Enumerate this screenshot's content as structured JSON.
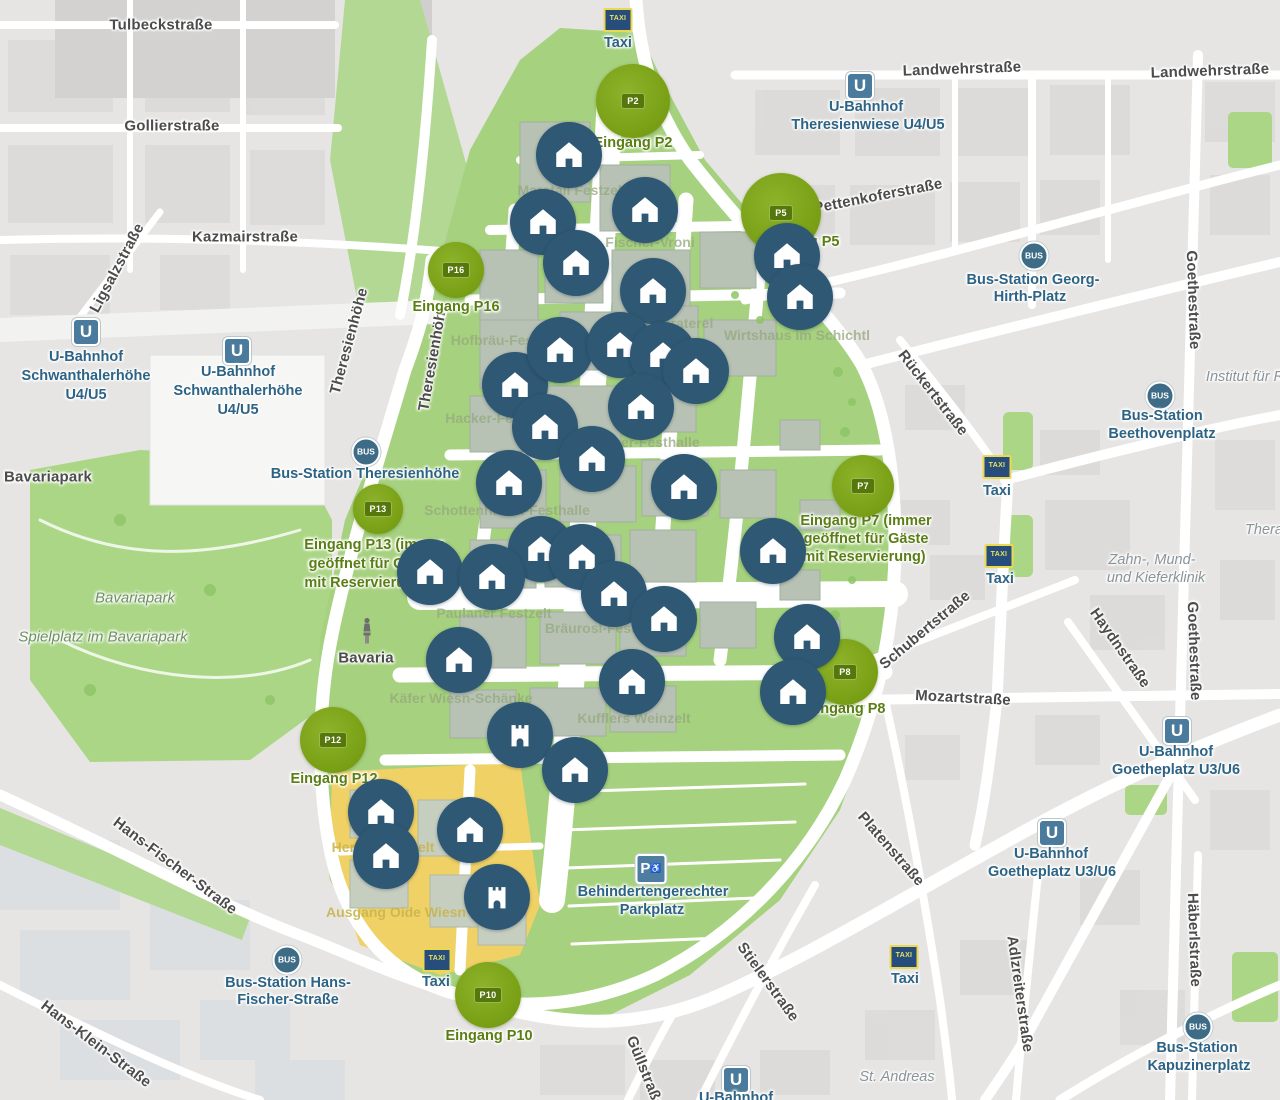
{
  "map": {
    "colors": {
      "city_gray": "#e6e5e3",
      "block_gray": "#d9d8d6",
      "road_white": "#ffffff",
      "park_green": "#a6d17e",
      "oide_wiesn_yellow": "#f0d166",
      "venue_marker_blue": "#2e5873",
      "entrance_green": "#7aa016",
      "entrance_badge_green": "#55770c",
      "entrance_label_green": "#5b7e14",
      "transit_blue": "#2d6385",
      "taxi_sign_blue": "#274d7c",
      "taxi_sign_border_yellow": "#ecd94f",
      "street_label_gray": "#4c4c4c",
      "faint_label_green": "#95a87e",
      "faint_label_yellow": "#c9b54e"
    },
    "icons": {
      "ubahn_text": "U",
      "bus_text": "BUS",
      "taxi_sign_text": "TAXI",
      "parking_text": "P",
      "wheelchair_glyph": "♿"
    },
    "street_labels": [
      {
        "text": "Tulbeckstraße",
        "x": 161,
        "y": 25,
        "rot": 0
      },
      {
        "text": "Gollierstraße",
        "x": 172,
        "y": 126,
        "rot": 0
      },
      {
        "text": "Kazmairstraße",
        "x": 245,
        "y": 237,
        "rot": 0
      },
      {
        "text": "Ligsalzstraße",
        "x": 117,
        "y": 268,
        "rot": -62
      },
      {
        "text": "Theresienhöhe",
        "x": 349,
        "y": 341,
        "rot": -75
      },
      {
        "text": "Theresienhöhe",
        "x": 433,
        "y": 357,
        "rot": -80
      },
      {
        "text": "Landwehrstraße",
        "x": 962,
        "y": 69,
        "rot": -2
      },
      {
        "text": "Landwehrstraße",
        "x": 1210,
        "y": 71,
        "rot": -2
      },
      {
        "text": "Pettenkoferstraße",
        "x": 878,
        "y": 196,
        "rot": -11
      },
      {
        "text": "Rückertstraße",
        "x": 933,
        "y": 393,
        "rot": 52
      },
      {
        "text": "Schubertstraße",
        "x": 925,
        "y": 630,
        "rot": -40
      },
      {
        "text": "Mozartstraße",
        "x": 963,
        "y": 698,
        "rot": 3
      },
      {
        "text": "Haydnstraße",
        "x": 1120,
        "y": 648,
        "rot": 55
      },
      {
        "text": "Goethestraße",
        "x": 1193,
        "y": 300,
        "rot": 88
      },
      {
        "text": "Goethestraße",
        "x": 1194,
        "y": 651,
        "rot": 88
      },
      {
        "text": "Häberlstraße",
        "x": 1194,
        "y": 940,
        "rot": 88
      },
      {
        "text": "Adlzreiterstraße",
        "x": 1020,
        "y": 994,
        "rot": 82
      },
      {
        "text": "Platenstraße",
        "x": 891,
        "y": 849,
        "rot": 49
      },
      {
        "text": "Stielerstraße",
        "x": 768,
        "y": 982,
        "rot": 54
      },
      {
        "text": "Güllstraße",
        "x": 645,
        "y": 1072,
        "rot": 68
      },
      {
        "text": "Hans-Fischer-Straße",
        "x": 175,
        "y": 866,
        "rot": 37
      },
      {
        "text": "Hans-Klein-Straße",
        "x": 96,
        "y": 1044,
        "rot": 37
      },
      {
        "text": "Bavariapark",
        "x": 48,
        "y": 477,
        "rot": 0
      }
    ],
    "park_labels": [
      {
        "text": "Bavariapark",
        "x": 135,
        "y": 598
      },
      {
        "text": "Spielplatz im Bavariapark",
        "x": 103,
        "y": 637
      }
    ],
    "poi_labels": [
      {
        "text": "Institut für R",
        "x": 1245,
        "y": 377
      },
      {
        "text": "Thera",
        "x": 1264,
        "y": 530
      },
      {
        "text": "Zahn-, Mund-",
        "x": 1152,
        "y": 560
      },
      {
        "text": "und Kieferklinik",
        "x": 1156,
        "y": 578
      },
      {
        "text": "St. Andreas",
        "x": 897,
        "y": 1077
      }
    ],
    "area_labels": [
      {
        "text": "Marstall Festzelt",
        "x": 572,
        "y": 190,
        "tone": "green"
      },
      {
        "text": "Fischer-Vroni",
        "x": 650,
        "y": 242,
        "tone": "green"
      },
      {
        "text": "Ochsenbraterei",
        "x": 662,
        "y": 323,
        "tone": "green"
      },
      {
        "text": "Wirtshaus im Schichtl",
        "x": 797,
        "y": 335,
        "tone": "green"
      },
      {
        "text": "Hofbräu-Festzelt",
        "x": 506,
        "y": 340,
        "tone": "green"
      },
      {
        "text": "Hacker-Festzelt",
        "x": 497,
        "y": 418,
        "tone": "green"
      },
      {
        "text": "Augustiner-Festhalle",
        "x": 630,
        "y": 442,
        "tone": "green"
      },
      {
        "text": "Schottenhamel-Festhalle",
        "x": 507,
        "y": 510,
        "tone": "green"
      },
      {
        "text": "Paulaner Festzelt",
        "x": 494,
        "y": 613,
        "tone": "green"
      },
      {
        "text": "Bräurosl-Festzelt",
        "x": 602,
        "y": 628,
        "tone": "green"
      },
      {
        "text": "Käfer Wiesn-Schänke",
        "x": 461,
        "y": 698,
        "tone": "green"
      },
      {
        "text": "Kufflers Weinzelt",
        "x": 634,
        "y": 718,
        "tone": "green"
      },
      {
        "text": "Herzkasperlzelt",
        "x": 383,
        "y": 847,
        "tone": "yellow"
      },
      {
        "text": "Ausgang Oide Wiesn",
        "x": 396,
        "y": 912,
        "tone": "yellow"
      }
    ],
    "transit_stations": [
      {
        "type": "ubahn",
        "icon": {
          "x": 86,
          "y": 332
        },
        "lines": [
          {
            "text": "U-Bahnhof",
            "x": 86,
            "y": 357
          },
          {
            "text": "Schwanthalerhöhe",
            "x": 86,
            "y": 376
          },
          {
            "text": "U4/U5",
            "x": 86,
            "y": 395
          }
        ]
      },
      {
        "type": "ubahn",
        "icon": {
          "x": 237,
          "y": 351
        },
        "lines": [
          {
            "text": "U-Bahnhof",
            "x": 238,
            "y": 372
          },
          {
            "text": "Schwanthalerhöhe",
            "x": 238,
            "y": 391
          },
          {
            "text": "U4/U5",
            "x": 238,
            "y": 410
          }
        ]
      },
      {
        "type": "ubahn",
        "icon": {
          "x": 860,
          "y": 86
        },
        "lines": [
          {
            "text": "U-Bahnhof",
            "x": 866,
            "y": 107
          },
          {
            "text": "Theresienwiese U4/U5",
            "x": 868,
            "y": 125
          }
        ]
      },
      {
        "type": "ubahn",
        "icon": {
          "x": 1177,
          "y": 731
        },
        "lines": [
          {
            "text": "U-Bahnhof",
            "x": 1176,
            "y": 752
          },
          {
            "text": "Goetheplatz U3/U6",
            "x": 1176,
            "y": 770
          }
        ]
      },
      {
        "type": "ubahn",
        "icon": {
          "x": 1052,
          "y": 833
        },
        "lines": [
          {
            "text": "U-Bahnhof",
            "x": 1051,
            "y": 854
          },
          {
            "text": "Goetheplatz U3/U6",
            "x": 1052,
            "y": 872
          }
        ]
      },
      {
        "type": "ubahn",
        "icon": {
          "x": 736,
          "y": 1080
        },
        "lines": [
          {
            "text": "U-Bahnhof",
            "x": 736,
            "y": 1098
          }
        ]
      },
      {
        "type": "bus",
        "icon": {
          "x": 366,
          "y": 452
        },
        "lines": [
          {
            "text": "Bus-Station Theresienhöhe",
            "x": 365,
            "y": 474
          }
        ]
      },
      {
        "type": "bus",
        "icon": {
          "x": 1034,
          "y": 256
        },
        "lines": [
          {
            "text": "Bus-Station Georg-",
            "x": 1033,
            "y": 280
          },
          {
            "text": "Hirth-Platz",
            "x": 1030,
            "y": 297
          }
        ]
      },
      {
        "type": "bus",
        "icon": {
          "x": 1160,
          "y": 396
        },
        "lines": [
          {
            "text": "Bus-Station",
            "x": 1162,
            "y": 416
          },
          {
            "text": "Beethovenplatz",
            "x": 1162,
            "y": 434
          }
        ]
      },
      {
        "type": "bus",
        "icon": {
          "x": 287,
          "y": 960
        },
        "lines": [
          {
            "text": "Bus-Station Hans-",
            "x": 288,
            "y": 983
          },
          {
            "text": "Fischer-Straße",
            "x": 288,
            "y": 1000
          }
        ]
      },
      {
        "type": "bus",
        "icon": {
          "x": 1198,
          "y": 1027
        },
        "lines": [
          {
            "text": "Bus-Station",
            "x": 1197,
            "y": 1048
          },
          {
            "text": "Kapuzinerplatz",
            "x": 1199,
            "y": 1066
          }
        ]
      }
    ],
    "taxi_stands": [
      {
        "sign": {
          "x": 618,
          "y": 20
        },
        "label": {
          "text": "Taxi",
          "x": 618,
          "y": 43
        }
      },
      {
        "sign": {
          "x": 997,
          "y": 467
        },
        "label": {
          "text": "Taxi",
          "x": 997,
          "y": 491
        }
      },
      {
        "sign": {
          "x": 999,
          "y": 556
        },
        "label": {
          "text": "Taxi",
          "x": 1000,
          "y": 579
        }
      },
      {
        "sign": {
          "x": 437,
          "y": 960
        },
        "label": {
          "text": "Taxi",
          "x": 436,
          "y": 982
        }
      },
      {
        "sign": {
          "x": 904,
          "y": 957
        },
        "label": {
          "text": "Taxi",
          "x": 905,
          "y": 979
        }
      }
    ],
    "parking": {
      "icon": {
        "x": 651,
        "y": 869
      },
      "lines": [
        {
          "text": "Behindertengerechter",
          "x": 653,
          "y": 892
        },
        {
          "text": "Parkplatz",
          "x": 652,
          "y": 910
        }
      ]
    },
    "bavaria": {
      "icon": {
        "x": 367,
        "y": 633
      },
      "label": {
        "text": "Bavaria",
        "x": 366,
        "y": 658
      }
    },
    "entrances": [
      {
        "id": "P2",
        "badge": "P2",
        "x": 633,
        "y": 101,
        "size": 74,
        "label_lines": [
          {
            "text": "Eingang P2",
            "x": 633,
            "y": 143
          }
        ]
      },
      {
        "id": "P5",
        "badge": "P5",
        "x": 781,
        "y": 213,
        "size": 80,
        "label_lines": [
          {
            "text": "Eingang P5",
            "x": 800,
            "y": 242
          }
        ]
      },
      {
        "id": "P16",
        "badge": "P16",
        "x": 456,
        "y": 270,
        "size": 56,
        "label_lines": [
          {
            "text": "Eingang P16",
            "x": 456,
            "y": 307
          }
        ]
      },
      {
        "id": "P13",
        "badge": "P13",
        "x": 378,
        "y": 509,
        "size": 50,
        "label_lines": [
          {
            "text": "Eingang P13 (immer",
            "x": 374,
            "y": 545
          },
          {
            "text": "geöffnet für Gäste",
            "x": 371,
            "y": 564
          },
          {
            "text": "mit Reservierung)",
            "x": 366,
            "y": 583
          }
        ]
      },
      {
        "id": "P7",
        "badge": "P7",
        "x": 863,
        "y": 486,
        "size": 62,
        "label_lines": [
          {
            "text": "Eingang P7 (immer",
            "x": 866,
            "y": 521
          },
          {
            "text": "geöffnet für Gäste",
            "x": 866,
            "y": 539
          },
          {
            "text": "mit Reservierung)",
            "x": 864,
            "y": 557
          }
        ]
      },
      {
        "id": "P8",
        "badge": "P8",
        "x": 845,
        "y": 672,
        "size": 66,
        "label_lines": [
          {
            "text": "Eingang P8",
            "x": 846,
            "y": 709
          }
        ]
      },
      {
        "id": "P12",
        "badge": "P12",
        "x": 333,
        "y": 740,
        "size": 66,
        "label_lines": [
          {
            "text": "Eingang P12",
            "x": 334,
            "y": 779
          }
        ]
      },
      {
        "id": "P10",
        "badge": "P10",
        "x": 488,
        "y": 995,
        "size": 66,
        "label_lines": [
          {
            "text": "Eingang P10",
            "x": 489,
            "y": 1036
          }
        ]
      }
    ],
    "venues": [
      {
        "x": 569,
        "y": 155,
        "icon": "house"
      },
      {
        "x": 543,
        "y": 222,
        "icon": "house"
      },
      {
        "x": 645,
        "y": 210,
        "icon": "house"
      },
      {
        "x": 576,
        "y": 263,
        "icon": "house"
      },
      {
        "x": 653,
        "y": 291,
        "icon": "house"
      },
      {
        "x": 787,
        "y": 256,
        "icon": "house"
      },
      {
        "x": 800,
        "y": 297,
        "icon": "house"
      },
      {
        "x": 515,
        "y": 385,
        "icon": "house"
      },
      {
        "x": 560,
        "y": 350,
        "icon": "house"
      },
      {
        "x": 620,
        "y": 345,
        "icon": "house"
      },
      {
        "x": 663,
        "y": 355,
        "icon": "house"
      },
      {
        "x": 696,
        "y": 371,
        "icon": "house"
      },
      {
        "x": 545,
        "y": 427,
        "icon": "house"
      },
      {
        "x": 641,
        "y": 407,
        "icon": "house"
      },
      {
        "x": 509,
        "y": 483,
        "icon": "house"
      },
      {
        "x": 592,
        "y": 459,
        "icon": "house"
      },
      {
        "x": 684,
        "y": 487,
        "icon": "house"
      },
      {
        "x": 773,
        "y": 551,
        "icon": "house"
      },
      {
        "x": 541,
        "y": 549,
        "icon": "house"
      },
      {
        "x": 582,
        "y": 557,
        "icon": "house"
      },
      {
        "x": 430,
        "y": 572,
        "icon": "house"
      },
      {
        "x": 492,
        "y": 577,
        "icon": "house"
      },
      {
        "x": 614,
        "y": 594,
        "icon": "house"
      },
      {
        "x": 664,
        "y": 619,
        "icon": "house"
      },
      {
        "x": 807,
        "y": 637,
        "icon": "house"
      },
      {
        "x": 459,
        "y": 660,
        "icon": "house"
      },
      {
        "x": 632,
        "y": 682,
        "icon": "house"
      },
      {
        "x": 793,
        "y": 692,
        "icon": "house"
      },
      {
        "x": 520,
        "y": 735,
        "icon": "castle"
      },
      {
        "x": 575,
        "y": 770,
        "icon": "house"
      },
      {
        "x": 381,
        "y": 812,
        "icon": "house"
      },
      {
        "x": 386,
        "y": 856,
        "icon": "house"
      },
      {
        "x": 470,
        "y": 830,
        "icon": "house"
      },
      {
        "x": 497,
        "y": 897,
        "icon": "castle"
      }
    ]
  }
}
